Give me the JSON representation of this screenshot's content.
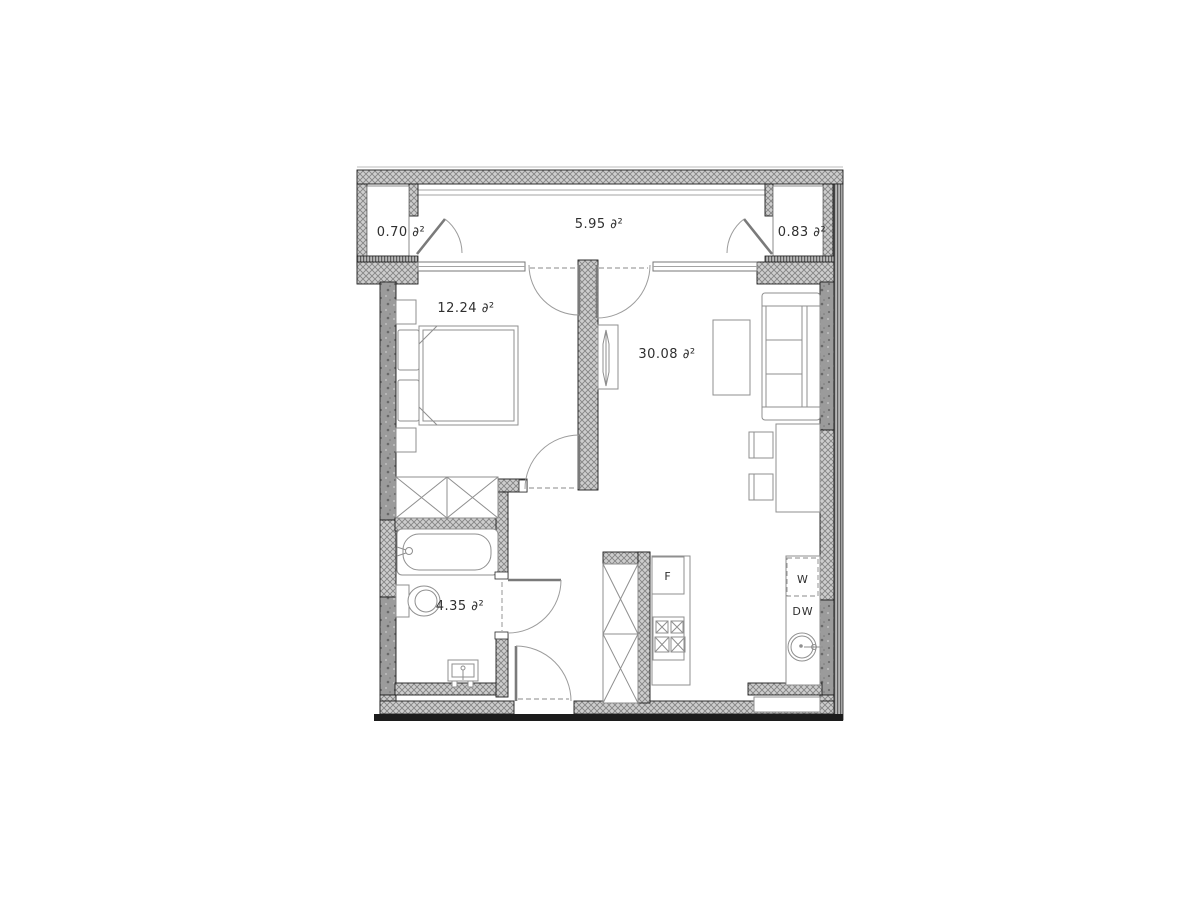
{
  "floor_plan": {
    "background": "#ffffff",
    "colors": {
      "wall_fill": "#cdcdcd",
      "wall_hatch_line": "#848484",
      "concrete_fill": "#9b9b9b",
      "outline": "#1c1c1c",
      "furniture_line": "#8f8f8f",
      "door_line": "#9c9c9c",
      "text": "#2f2f2f"
    },
    "rooms": [
      {
        "id": "left-balcony-closet",
        "area_label": "0.70 ∂²"
      },
      {
        "id": "balcony",
        "area_label": "5.95 ∂²"
      },
      {
        "id": "right-balcony-closet",
        "area_label": "0.83 ∂²"
      },
      {
        "id": "bedroom",
        "area_label": "12.24 ∂²"
      },
      {
        "id": "living-room",
        "area_label": "30.08 ∂²"
      },
      {
        "id": "bathroom",
        "area_label": "4.35 ∂²"
      }
    ],
    "appliances": [
      {
        "id": "fridge",
        "label": "F"
      },
      {
        "id": "washing-machine",
        "label": "W"
      },
      {
        "id": "dishwasher",
        "label": "DW"
      }
    ]
  }
}
